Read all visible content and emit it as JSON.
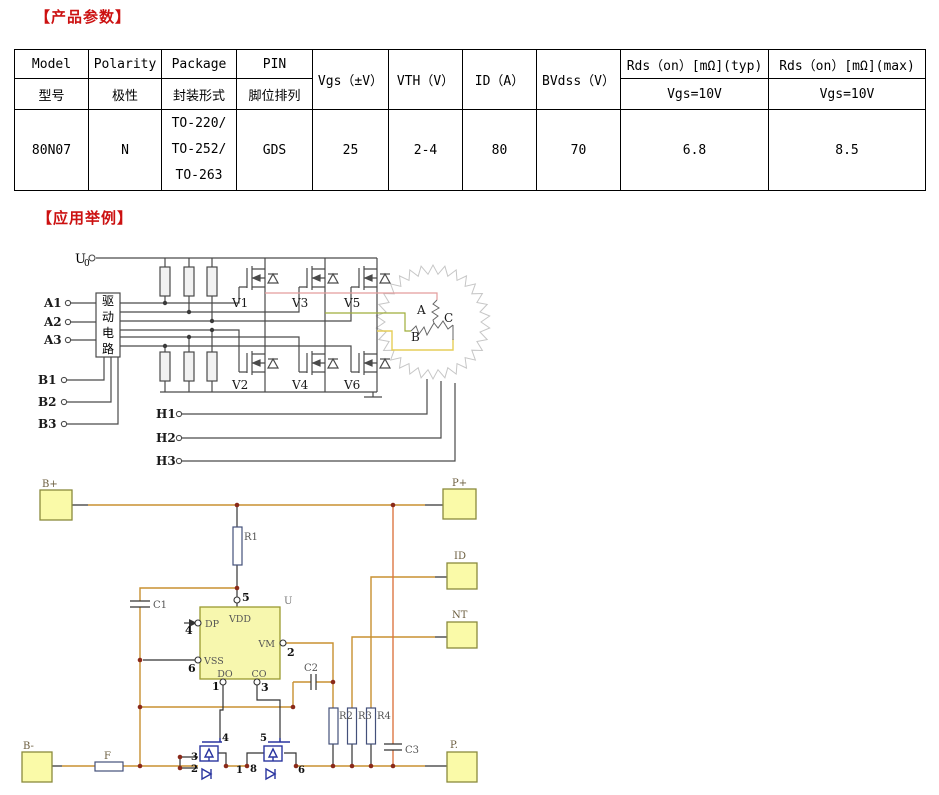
{
  "titles": {
    "params": "【产品参数】",
    "examples": "【应用举例】"
  },
  "colors": {
    "title_red": "#cc1111",
    "wire_orange": "#c89030",
    "wire_red": "#dd7744",
    "terminal_fill": "#fafaa8",
    "ic_fill": "#f7f7ae",
    "wire_pink": "#e39c9c",
    "wire_green": "#9fae3a",
    "wire_yellow": "#e5ce58",
    "mosfet_blue": "#2a35a0"
  },
  "table": {
    "header": {
      "model_en": "Model",
      "model_zh": "型号",
      "polarity_en": "Polarity",
      "polarity_zh": "极性",
      "package_en": "Package",
      "package_zh": "封装形式",
      "pin_en": "PIN",
      "pin_zh": "脚位排列",
      "vgs": "Vgs（±V）",
      "vth": "VTH（V）",
      "id": "ID（A）",
      "bvdss": "BVdss（V）",
      "rds_typ": "Rds（on）[mΩ](typ)",
      "rds_typ_sub": "Vgs=10V",
      "rds_max": "Rds（on）[mΩ](max)",
      "rds_max_sub": "Vgs=10V"
    },
    "row": {
      "model": "80N07",
      "polarity": "N",
      "package1": "TO-220/",
      "package2": "TO-252/",
      "package3": "TO-263",
      "pin": "GDS",
      "vgs": "25",
      "vth": "2-4",
      "id": "80",
      "bvdss": "70",
      "rds_typ": "6.8",
      "rds_max": "8.5"
    }
  },
  "diagram1": {
    "u0": "U",
    "u0_sub": "0",
    "driver": [
      "驱",
      "动",
      "电",
      "路"
    ],
    "a_inputs": [
      "A1",
      "A2",
      "A3"
    ],
    "b_inputs": [
      "B1",
      "B2",
      "B3"
    ],
    "v_top": [
      "V1",
      "V3",
      "V5"
    ],
    "v_bottom": [
      "V2",
      "V4",
      "V6"
    ],
    "h_lines": [
      "H1",
      "H2",
      "H3"
    ],
    "phases": [
      "A",
      "B",
      "C"
    ]
  },
  "diagram2": {
    "b_plus": "B+",
    "p_plus": "P+",
    "id_term": "ID",
    "nt_term": "NT",
    "b_minus": "B-",
    "p_minus": "P.",
    "fuse": "F",
    "ic_ref": "U",
    "ic_pins": {
      "vdd": "VDD",
      "dp": "DP",
      "vss": "VSS",
      "vm": "VM",
      "do": "DO",
      "co": "CO"
    },
    "pin_nums": {
      "vdd": "5",
      "dp": "4",
      "vss": "6",
      "vm": "2",
      "do": "1",
      "co": "3"
    },
    "r1": "R1",
    "r2": "R2",
    "r3": "R3",
    "r4": "R4",
    "c1": "C1",
    "c2": "C2",
    "c3": "C3",
    "q_pins": {
      "g1": "4",
      "s1a": "3",
      "s1b": "2",
      "d1": "1",
      "d2": "8",
      "g2": "5",
      "s2": "6"
    }
  }
}
